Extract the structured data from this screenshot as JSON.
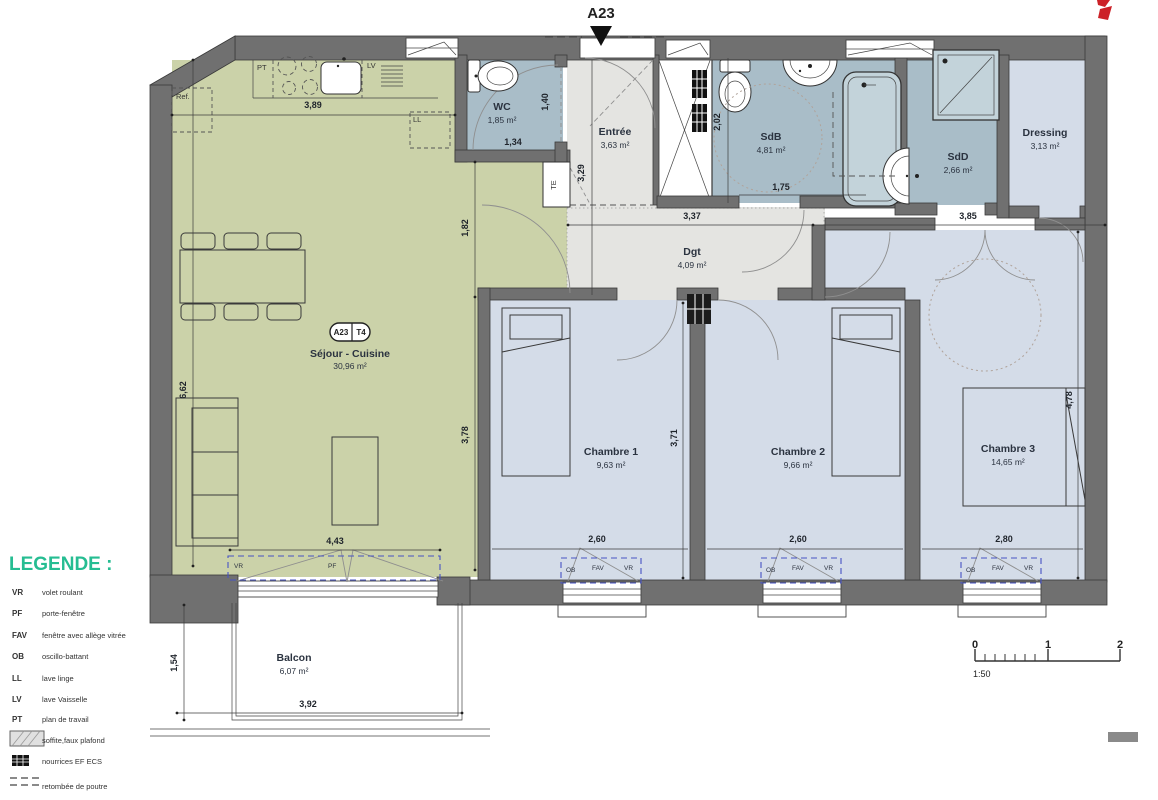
{
  "plan": {
    "entrance_tag": "A23",
    "badge": {
      "unit": "A23",
      "type": "T4"
    },
    "rooms": [
      {
        "id": "sejour",
        "name": "Séjour - Cuisine",
        "area": "30,96 m²"
      },
      {
        "id": "wc",
        "name": "WC",
        "area": "1,85 m²"
      },
      {
        "id": "entree",
        "name": "Entrée",
        "area": "3,63 m²"
      },
      {
        "id": "sdb",
        "name": "SdB",
        "area": "4,81 m²"
      },
      {
        "id": "sdd",
        "name": "SdD",
        "area": "2,66 m²"
      },
      {
        "id": "dressing",
        "name": "Dressing",
        "area": "3,13 m²"
      },
      {
        "id": "dgt",
        "name": "Dgt",
        "area": "4,09 m²"
      },
      {
        "id": "ch1",
        "name": "Chambre 1",
        "area": "9,63 m²"
      },
      {
        "id": "ch2",
        "name": "Chambre 2",
        "area": "9,66 m²"
      },
      {
        "id": "ch3",
        "name": "Chambre 3",
        "area": "14,65 m²"
      },
      {
        "id": "balcon",
        "name": "Balcon",
        "area": "6,07 m²"
      }
    ],
    "appliances": {
      "pt": "PT",
      "lv": "LV",
      "ll": "LL",
      "ref": "Ref.",
      "te": "TE"
    },
    "windows": {
      "vr": "VR",
      "pf": "PF",
      "ob": "OB",
      "fav": "FAV"
    },
    "dims": {
      "d_kitchen": "3,89",
      "d_sejour_h": "6,62",
      "d_nook": "1,82",
      "d_sejour_s": "3,78",
      "d_sejour_w": "4,43",
      "d_wc_w": "1,34",
      "d_wc_h": "1,40",
      "d_entree": "3,29",
      "d_sdb_h": "2,02",
      "d_sdb_w": "1,75",
      "d_dgt": "3,37",
      "d_right": "3,85",
      "d_ch_h": "3,71",
      "d_ch1_w": "2,60",
      "d_ch2_w": "2,60",
      "d_ch3_w": "2,80",
      "d_ch3_h": "4,78",
      "d_balcon_h": "1,54",
      "d_balcon_w": "3,92"
    }
  },
  "legend": {
    "title": "LEGENDE :",
    "items": [
      {
        "abbr": "VR",
        "label": "volet roulant"
      },
      {
        "abbr": "PF",
        "label": "porte-fenêtre"
      },
      {
        "abbr": "FAV",
        "label": "fenêtre avec allège vitrée"
      },
      {
        "abbr": "OB",
        "label": "oscillo-battant"
      },
      {
        "abbr": "LL",
        "label": "lave linge"
      },
      {
        "abbr": "LV",
        "label": "lave Vaisselle"
      },
      {
        "abbr": "PT",
        "label": "plan de travail"
      },
      {
        "abbr": "",
        "label": "soffite,faux plafond"
      },
      {
        "abbr": "",
        "label": "nourrices EF ECS"
      },
      {
        "abbr": "",
        "label": "retombée de poutre"
      }
    ]
  },
  "scalebar": {
    "t0": "0",
    "t1": "1",
    "t2": "2",
    "ratio": "1:50"
  }
}
